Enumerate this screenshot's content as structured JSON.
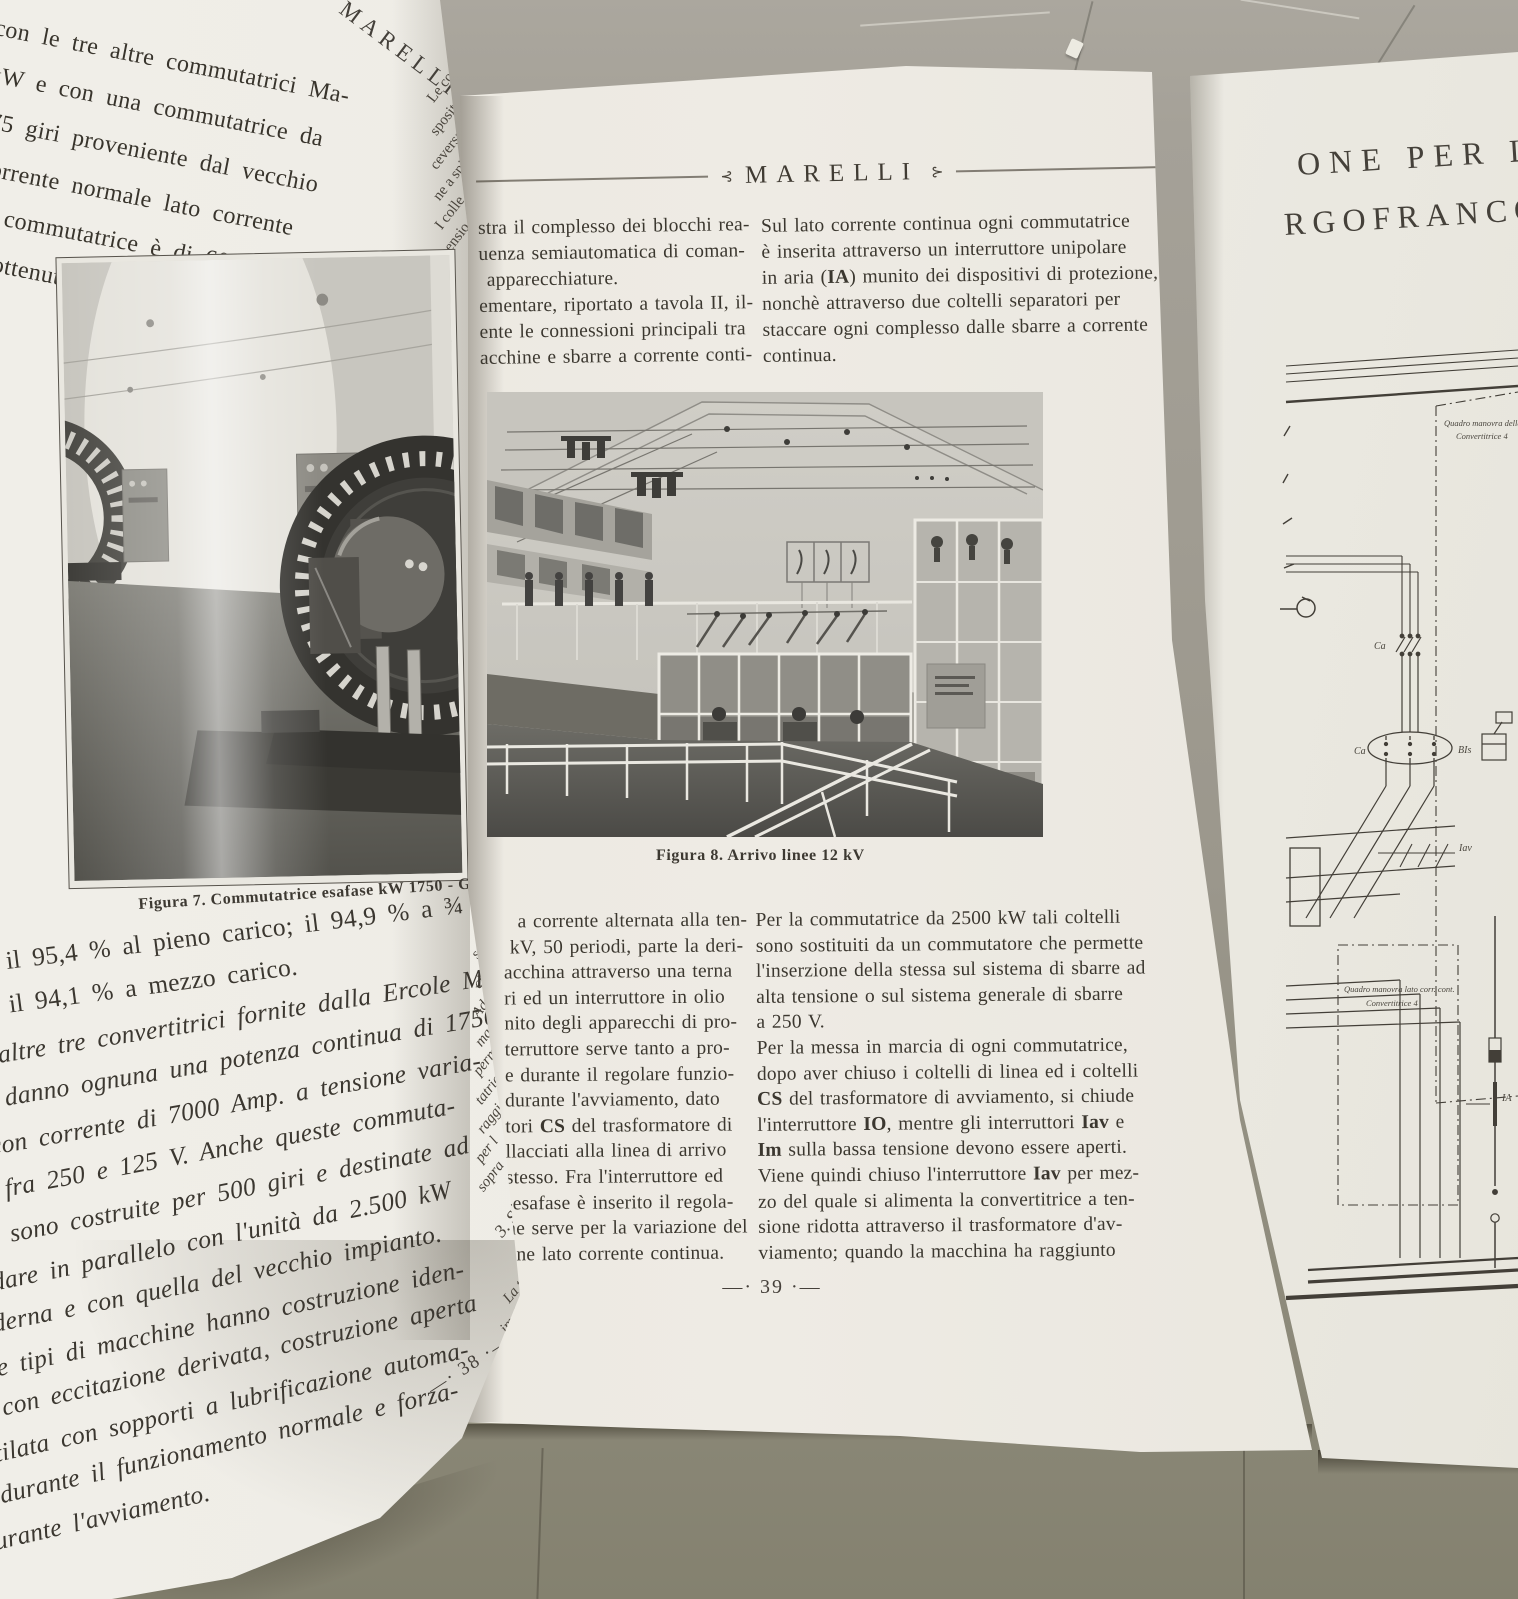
{
  "background": {
    "floor_upper_color": "#a8a49b",
    "floor_lower_color": "#8a877a"
  },
  "left_page": {
    "running_head_fragment": "MARELLI",
    "top_lines": [
      "richi con le tre altre commutatrici Ma-",
      "1750 kW e con una commutatrice da",
      "W a 375 giri proveniente dal vecchio",
      "o. La corrente normale lato corrente",
      "a di tale commutatrice è di 6000 Amp.",
      "ndimenti ottenuti a cosfi=1 raggiungo-"
    ],
    "edge_fragments_top": [
      "Le co",
      "sposit",
      "ceversa",
      "ne a spi",
      "I colle",
      "mensio"
    ],
    "figure7": {
      "caption": "Figura 7. Commutatrice esafase kW 1750 - Giri 500"
    },
    "bottom_lines": [
      "il 95,4 % al pieno carico; il 94,9 % a ¾ di ca-",
      ": il 94,1 % a mezzo carico.",
      "altre tre convertitrici fornite dalla Ercole Ma-",
      "i danno ognuna una potenza continua di 1750",
      "con corrente di 7000 Amp. a tensione varia-",
      "e fra 250 e 125 V. Anche queste commuta-",
      "ti sono costruite per 500 giri e destinate ad",
      "dare in parallelo con l'unità da 2.500 kW",
      "oderna e con quella del vecchio impianto.",
      "ue tipi di macchine hanno costruzione iden-",
      "a con eccitazione derivata, costruzione aperta",
      "ntilata con sopporti a lubrificazione automa-",
      "a durante il funzionamento normale e forza-",
      "durante l'avviamento."
    ],
    "edge_fragments_bottom": [
      "senza",
      "circa",
      "Ad og",
      "mani",
      "perm",
      "tatric",
      "raggi",
      "per l",
      "sopra"
    ],
    "edge_fragments_lower": [
      "3. Sch",
      "La tr",
      "impi"
    ],
    "page_number": "—· 38 ·—"
  },
  "center_page": {
    "header": {
      "ornament_left": "⊰",
      "title": "MARELLI",
      "ornament_right": "⊱"
    },
    "col1_top": {
      "lines": [
        "stra il complesso dei blocchi rea-",
        "uenza semiautomatica di coman-",
        "apparecchiature.",
        "ementare, riportato a tavola II, il-",
        "ente le connessioni principali tra",
        "acchine e sbarre a corrente conti-"
      ]
    },
    "col2_top": {
      "line1": "Sul lato corrente continua ogni commutatrice",
      "line2": "è inserita attraverso un interruttore unipolare",
      "line3": {
        "pre": "in aria (",
        "bold": "IA",
        "post": ") munito dei dispositivi di protezione,"
      },
      "line4": "nonchè attraverso due coltelli separatori per",
      "line5": "staccare ogni complesso dalle sbarre a corrente",
      "line6": "continua."
    },
    "figure8": {
      "caption": "Figura 8. Arrivo linee 12 kV"
    },
    "col1_bottom": {
      "line1": "a corrente alternata alla ten-",
      "line2": "kV, 50 periodi, parte la deri-",
      "line3": "acchina attraverso una terna",
      "line4": "ri ed un interruttore in olio",
      "line5": "nito degli apparecchi di pro-",
      "line6": "terruttore serve tanto a pro-",
      "line7": "e durante il regolare funzio-",
      "line8": "durante l'avviamento, dato",
      "line9": {
        "pre": "tori ",
        "bold": "CS",
        "post": " del trasformatore di"
      },
      "line10": "llacciati alla linea di arrivo",
      "line11": "stesso. Fra l'interruttore ed",
      "line12": "-esafase è inserito il regola-",
      "line13": "ne serve per la variazione del",
      "line14": "one lato corrente continua."
    },
    "col2_bottom": {
      "line1": "Per la commutatrice da 2500 kW tali coltelli",
      "line2": "sono sostituiti da un commutatore che permette",
      "line3": "l'inserzione della stessa sul sistema di sbarre ad",
      "line4": "alta tensione o sul sistema generale di sbarre",
      "line5": "a 250 V.",
      "line6": "Per la messa in marcia di ogni commutatrice,",
      "line7": "dopo aver chiuso i coltelli di linea ed i coltelli",
      "line8": {
        "bold": "CS",
        "post": " del trasformatore di avviamento, si chiude"
      },
      "line9": {
        "pre": "l'interruttore ",
        "bold1": "IO",
        "mid": ", mentre gli interruttori ",
        "bold2": "Iav",
        "post": " e"
      },
      "line10": {
        "bold": "Im",
        "post": " sulla bassa tensione devono essere aperti."
      },
      "line11": {
        "pre": "Viene quindi chiuso l'interruttore ",
        "bold": "Iav",
        "post": " per mez-"
      },
      "line12": "zo del quale si alimenta la convertitrice a ten-",
      "line13": "sione ridotta attraverso il trasformatore d'av-",
      "line14": "viamento; quando la macchina ha raggiunto"
    },
    "page_number": "—· 39 ·—"
  },
  "foldout": {
    "title_line1": "ONE PER LA",
    "title_line2": "RGOFRANCO",
    "diagram_labels": {
      "ca_switch": "Ca",
      "ca_oval": "Ca",
      "iav": "Iav",
      "bis": "BIs",
      "ia": "IA",
      "upper_box_line1": "Quadro manovra della",
      "upper_box_line2": "Convertitrice 4",
      "lower_box_line1": "Quadro manovra lato corr. cont.",
      "lower_box_line2": "Convertitrice 4"
    }
  }
}
